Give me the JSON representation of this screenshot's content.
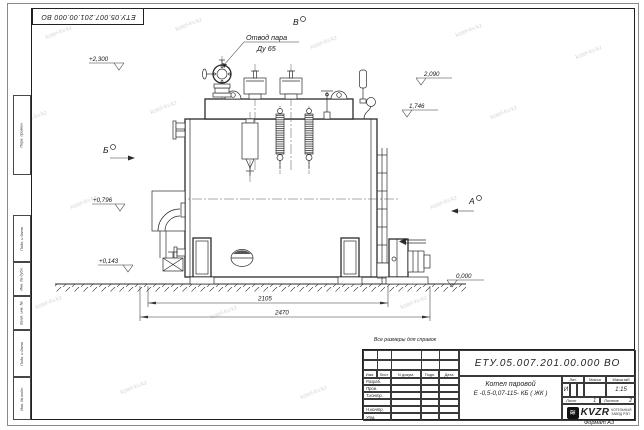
{
  "watermark": "kotel-kv.kz",
  "note_above_title": "Все размеры для справок",
  "format_note": "Формат А3",
  "drawing": {
    "steam_outlet_label_line1": "Отвод пара",
    "steam_outlet_label_line2": "Ду 65",
    "view_top": "В",
    "view_left": "Б",
    "view_right": "А",
    "elevations": {
      "top_left": "+2,300",
      "right_upper": "2,090",
      "right_mid": "1,746",
      "left_mid": "+0,796",
      "left_lower": "+0,143",
      "ground": "0,000"
    },
    "dimensions": {
      "inner": "2105",
      "outer": "2470"
    }
  },
  "title_block": {
    "doc_number": "ЕТУ.05.007.201.00.000  ВО",
    "product_name_line1": "Котел паровой",
    "product_name_line2": "Е -0,5-0,07-115- КБ ( ЖК )",
    "col_izm": "Изм.",
    "col_list": "Лист",
    "col_ndocum": "N докум.",
    "col_podp": "Подп.",
    "col_data": "Дата",
    "row_razrab": "Разраб.",
    "row_prov": "Пров.",
    "row_tkontr": "Т.контр.",
    "row_nkontr": "Н.контр.",
    "row_utv": "Утв.",
    "lit_header": "Лит.",
    "mass_header": "Масса",
    "scale_header": "Масштаб",
    "lit_value": "И",
    "scale_value": "1:15",
    "sheet_label": "Лист",
    "sheet_value": "1",
    "sheets_label": "Листов",
    "sheets_value": "2",
    "company_logo": "KVZR",
    "company_line1": "КОТЕЛЬНЫЙ",
    "company_line2": "ЗАВОД РЭП"
  },
  "margin": {
    "perv_primen": "Перв. примен.",
    "podp_data_1": "Подп. и дата",
    "inv_dubl": "Инв. № дубл.",
    "vzam_inv": "Взам. инв. №",
    "podp_data_2": "Подп. и дата",
    "inv_podl": "Инв. № подл."
  }
}
